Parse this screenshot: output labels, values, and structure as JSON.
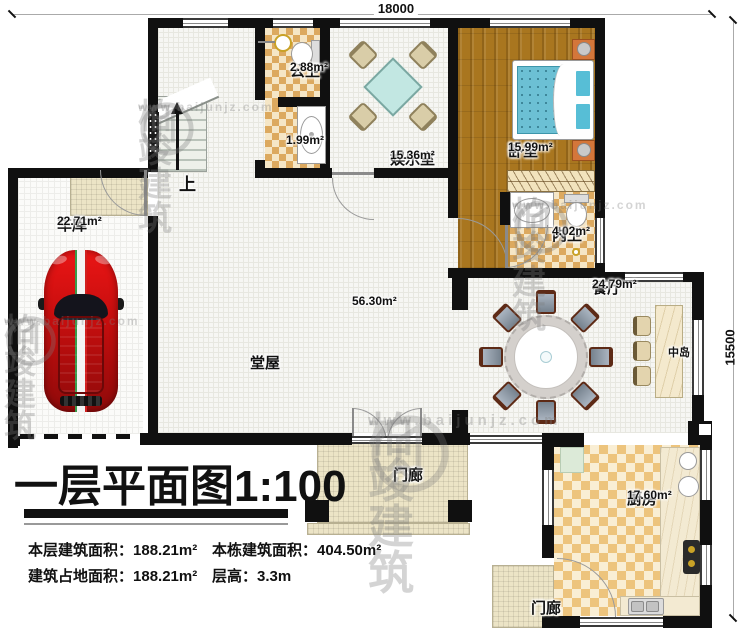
{
  "dimensions": {
    "top": "18000",
    "right": "15500"
  },
  "rooms": {
    "garage": {
      "name": "车库",
      "area": "22.71m²"
    },
    "public_bath": {
      "name": "公卫",
      "area": "2.88m²"
    },
    "washroom": {
      "name": "",
      "area": "1.99m²"
    },
    "entertainment": {
      "name": "娱乐室",
      "area": "15.36m²"
    },
    "bedroom": {
      "name": "卧室",
      "area": "15.99m²"
    },
    "ensuite": {
      "name": "内卫",
      "area": "4.02m²"
    },
    "dining": {
      "name": "餐厅",
      "area": "24.79m²"
    },
    "island": {
      "name": "中岛"
    },
    "hall": {
      "name": "堂屋",
      "area": "56.30m²"
    },
    "kitchen": {
      "name": "厨房",
      "area": "17.60m²"
    },
    "porch_front": {
      "name": "门廊"
    },
    "porch_side": {
      "name": "门廊"
    }
  },
  "stairs": {
    "up_label": "上"
  },
  "title": {
    "text": "一层平面图",
    "scale": "1:100"
  },
  "stats": [
    {
      "label": "本层建筑面积：",
      "value": "188.21m²"
    },
    {
      "label": "本栋建筑面积：",
      "value": "404.50m²"
    },
    {
      "label": "建筑占地面积：",
      "value": "188.21m²"
    },
    {
      "label": "层高：",
      "value": "3.3m"
    }
  ],
  "watermark": {
    "brand": "柏竣建筑",
    "url": "www.baijunjz.com"
  },
  "colors": {
    "wall": "#101010",
    "wood_floor": "#a9761f",
    "bath_tile": "#dca95f",
    "kitchen_tile": "#edc47d",
    "porch": "#ece4c6",
    "car": "#d01010",
    "bed": "#6cc0d4",
    "grid_floor": "#f6f6f3"
  }
}
